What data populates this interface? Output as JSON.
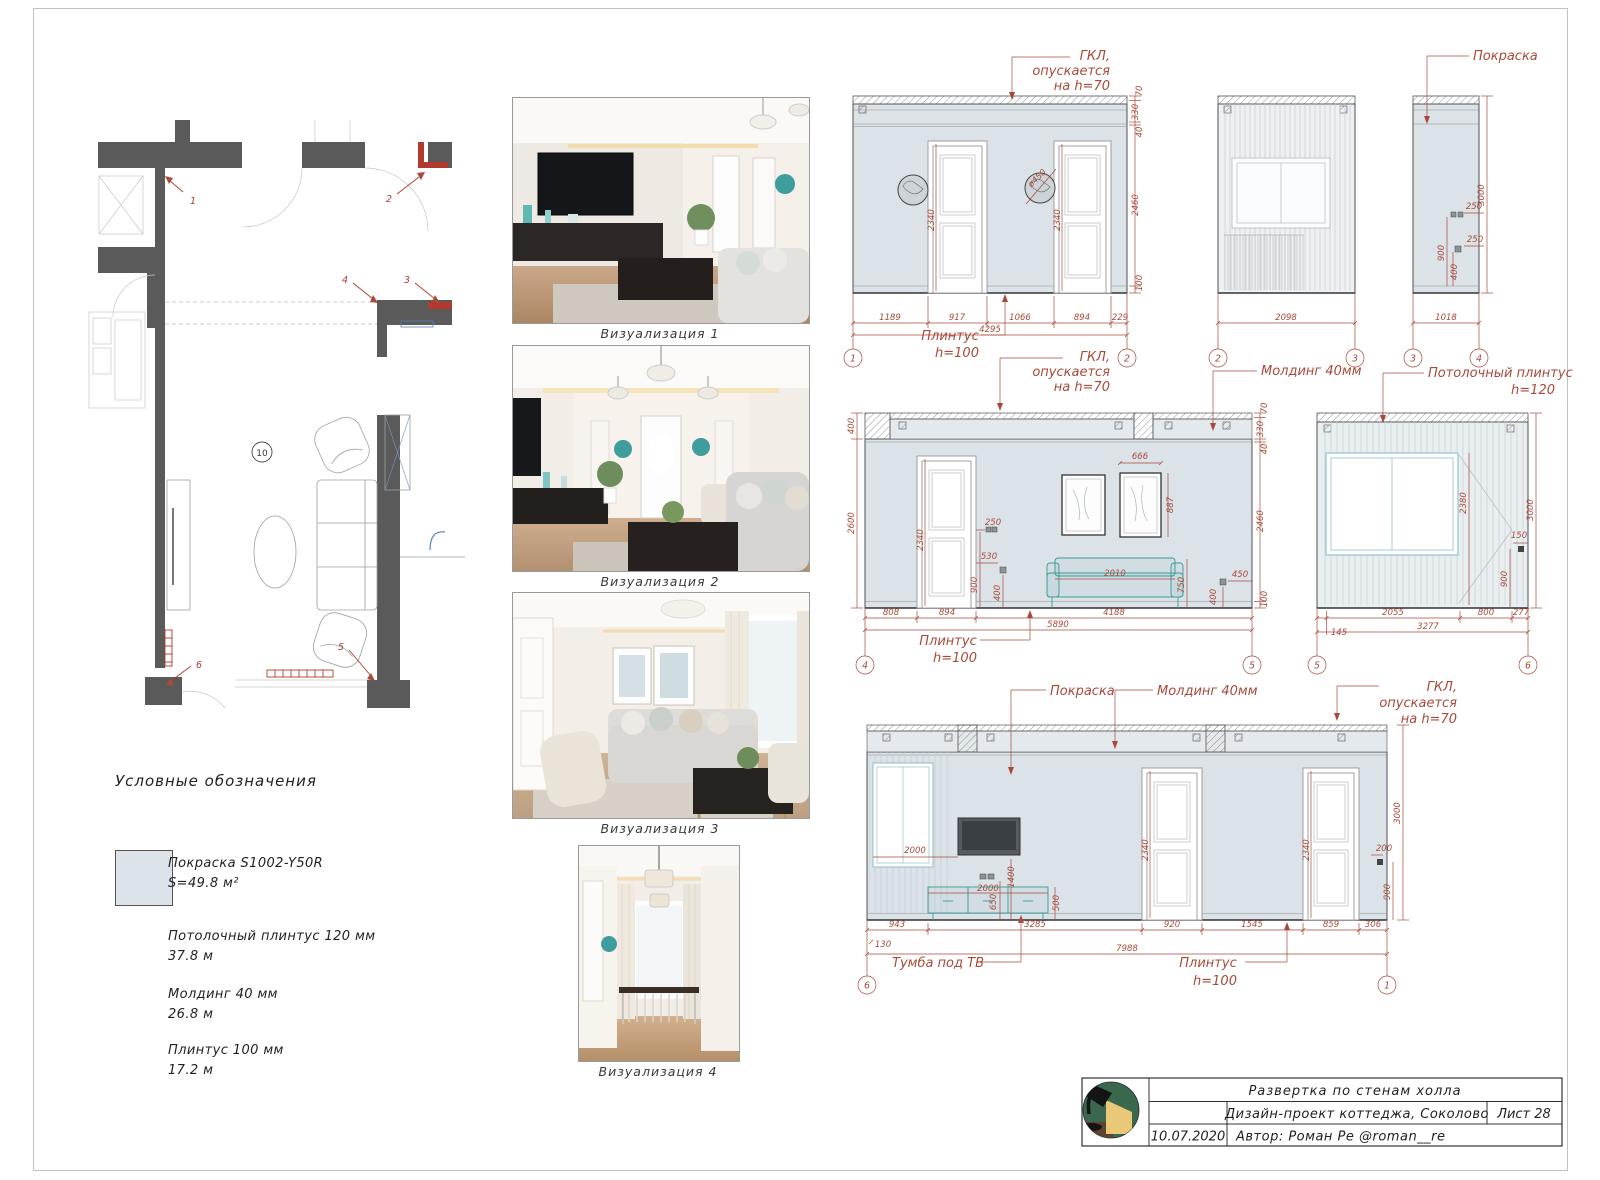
{
  "colors": {
    "accent": "#a84a3a",
    "wall_fill": "#dbe2e8",
    "plan_wall": "#5a5a5a",
    "teal": "#3a9a96",
    "logo_green": "#3a684e",
    "logo_yellow": "#e9c878",
    "logo_brown": "#5d4430"
  },
  "plan": {
    "room": "10",
    "markers": [
      "1",
      "2",
      "3",
      "4",
      "5",
      "6"
    ]
  },
  "legend": {
    "title": "Условные обозначения",
    "paint_name": "Покраска S1002-Y50R",
    "paint_area": "S=49.8 м²",
    "items": [
      {
        "l1": "Потолочный плинтус 120 мм",
        "l2": "37.8 м"
      },
      {
        "l1": "Молдинг 40 мм",
        "l2": "26.8 м"
      },
      {
        "l1": "Плинтус 100 мм",
        "l2": "17.2 м"
      }
    ]
  },
  "renders": [
    {
      "caption": "Визуализация 1"
    },
    {
      "caption": "Визуализация 2"
    },
    {
      "caption": "Визуализация 3"
    },
    {
      "caption": "Визуализация 4"
    }
  ],
  "ann": {
    "gkl1": "ГКЛ,",
    "gkl2": "опускается",
    "gkl3": "на h=70",
    "paint": "Покраска",
    "molding": "Молдинг 40мм",
    "cp1": "Потолочный плинтус",
    "cp2": "h=120",
    "pl1": "Плинтус",
    "pl2": "h=100",
    "tv": "Тумба под ТВ"
  },
  "e12": {
    "b0": "1189",
    "b1": "917",
    "b2": "1066",
    "b3": "894",
    "b4": "229",
    "total": "4295",
    "r0": "70",
    "r1": "330",
    "r2": "40",
    "r3": "2460",
    "r4": "100",
    "door": "2340",
    "diam": "ø450",
    "bub1": "1",
    "bub2": "2"
  },
  "e23": {
    "total": "2098",
    "bub1": "2",
    "bub2": "3"
  },
  "e34": {
    "h": "3000",
    "s1": "250",
    "s2": "250",
    "v1": "900",
    "v2": "400",
    "total": "1018",
    "bub1": "3",
    "bub2": "4"
  },
  "e45": {
    "l0": "400",
    "l1": "2600",
    "r0": "70",
    "r1": "330",
    "r2": "40",
    "r3": "2460",
    "r4": "100",
    "door": "2340",
    "pw": "666",
    "ph": "887",
    "sw": "2010",
    "sh": "750",
    "s1": "250",
    "s2": "530",
    "v1": "900",
    "v2": "400",
    "s3": "450",
    "v3": "400",
    "b0": "808",
    "b1": "894",
    "b2": "4188",
    "total": "5890",
    "bub1": "4",
    "bub2": "5"
  },
  "e56": {
    "h": "3000",
    "win": "2380",
    "s1": "150",
    "v1": "900",
    "b0": "2055",
    "b1": "800",
    "b2": "277",
    "b3": "145",
    "total": "3277",
    "bub1": "5",
    "bub2": "6"
  },
  "e61": {
    "h": "3000",
    "door": "2340",
    "tvd": "2000",
    "v1": "1400",
    "v2": "650",
    "v3": "500",
    "cw": "2000",
    "s1": "200",
    "sv": "900",
    "b0": "943",
    "b1": "3285",
    "b2": "920",
    "b3": "1545",
    "b4": "859",
    "b5": "306",
    "b6": "130",
    "total": "7988",
    "bub1": "6",
    "bub2": "1"
  },
  "title_block": {
    "title": "Развертка по стенам холла",
    "project": "Дизайн-проект коттеджа, Соколово",
    "sheet_no": "Лист 28",
    "date": "10.07.2020",
    "author": "Автор: Роман Ре @roman__re"
  }
}
